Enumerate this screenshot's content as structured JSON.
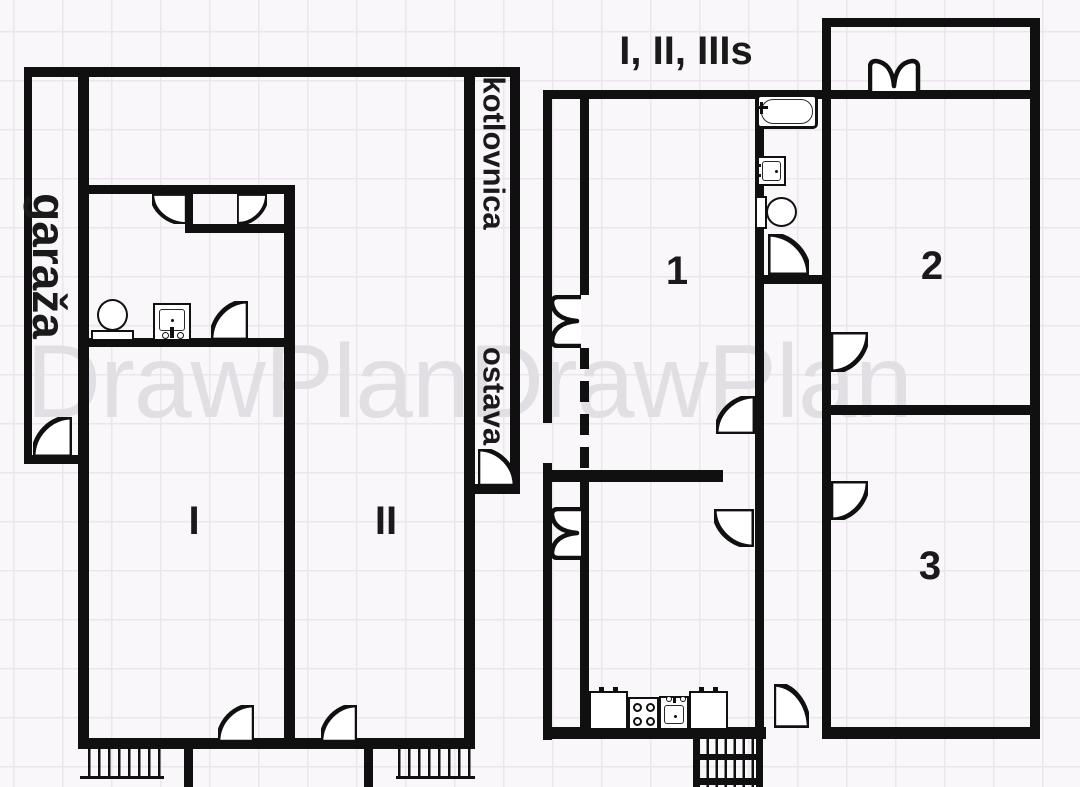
{
  "watermark": "DrawPlanDrawPlan",
  "colors": {
    "wall": "#101010",
    "grid": "#eae6ec",
    "background": "#f9f7fa",
    "watermark": "#e2dfe4",
    "text": "#1a1a1a"
  },
  "left_plan": {
    "garage_label": "garaža",
    "boiler_room_label": "kotlovnica",
    "storage_label": "ostava",
    "room_1_label": "I",
    "room_2_label": "II"
  },
  "right_plan": {
    "title": "I, II, IIIs",
    "room_1_label": "1",
    "room_2_label": "2",
    "room_3_label": "3"
  }
}
